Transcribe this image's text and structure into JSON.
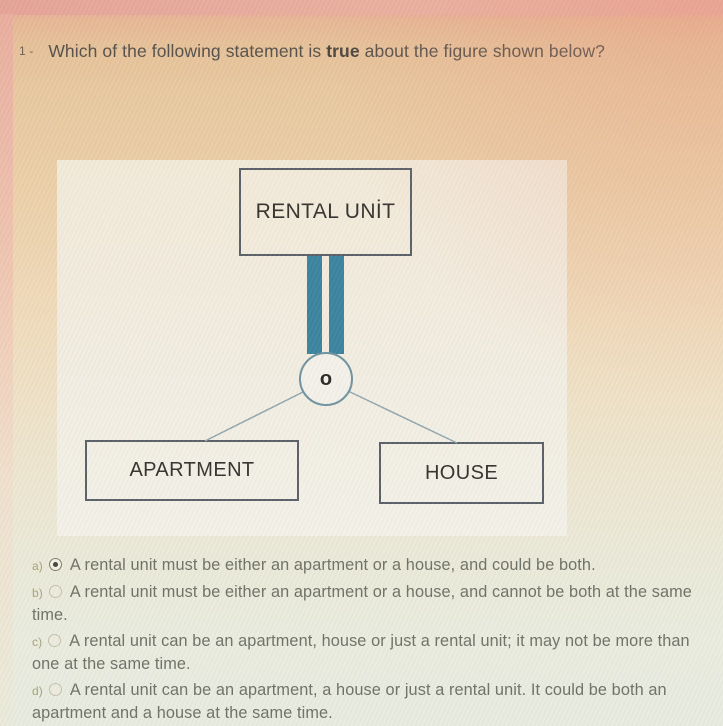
{
  "question": {
    "number": "1 -",
    "text_before": "Which of the following statement is ",
    "bold_word": "true",
    "text_after": " about the figure shown below?"
  },
  "figure": {
    "top_box_label": "RENTAL UNİT",
    "circle_label": "o",
    "left_box_label": "APARTMENT",
    "right_box_label": "HOUSE"
  },
  "options": [
    {
      "letter": "a)",
      "text": "A rental unit must be either an apartment or a house, and could be both.",
      "selected": true
    },
    {
      "letter": "b)",
      "text": "A rental unit must be either an apartment or a house, and cannot be both at the same time.",
      "selected": false
    },
    {
      "letter": "c)",
      "text": "A rental unit can be an apartment, house or just a rental unit; it may not be more than one at the same time.",
      "selected": false
    },
    {
      "letter": "d)",
      "text": "A rental unit can be an apartment, a house or just a rental unit. It could be both an apartment and a house at the same time.",
      "selected": false
    }
  ],
  "blank_option": {
    "label": "Boş bırak",
    "selected": false
  },
  "colors": {
    "teal_connector": "#3c84a0",
    "box_border": "#5b6069",
    "connector_line": "#93a7ae",
    "selected_radio_dot": "#44423a"
  }
}
